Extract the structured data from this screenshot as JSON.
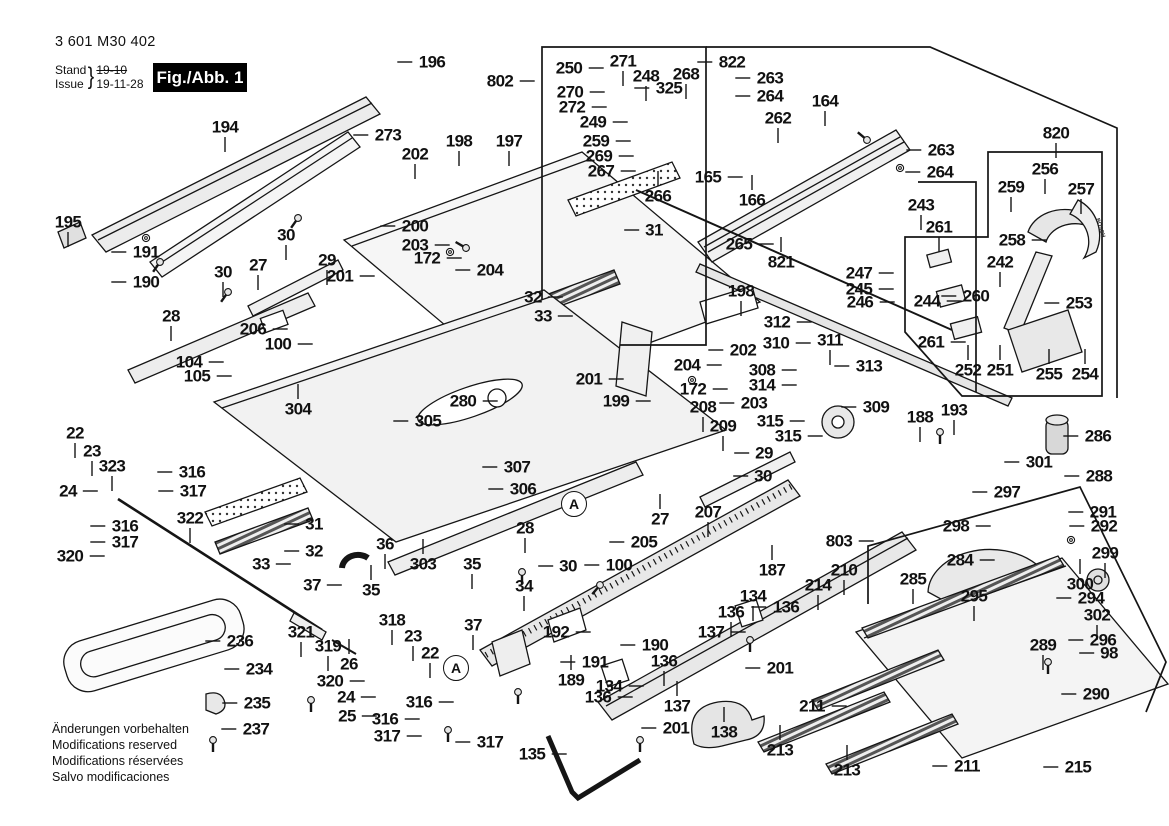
{
  "doc": {
    "part_number": "3 601 M30 402",
    "stand_label": "Stand",
    "issue_label": "Issue",
    "brace": "}",
    "date_struck": "19-10",
    "date": "19-11-28",
    "figure_badge": "Fig./Abb. 1",
    "footer_lines": [
      "Änderungen vorbehalten",
      "Modifications reserved",
      "Modifications réservées",
      "Salvo modificaciones"
    ]
  },
  "colors": {
    "ink": "#151515",
    "badge_bg": "#000000",
    "badge_fg": "#ffffff",
    "fill_light": "#f4f4f4",
    "fill_mid": "#e8e8e8",
    "fill_dark": "#d2d2d2"
  },
  "drawing_texts": [
    {
      "t": "BOSCH",
      "x": 1100,
      "y": 228,
      "rot": 72
    }
  ],
  "detail_circles": [
    {
      "t": "A",
      "x": 574,
      "y": 504
    },
    {
      "t": "A",
      "x": 456,
      "y": 668
    }
  ],
  "callouts": [
    {
      "t": "194",
      "x": 225,
      "y": 127,
      "d": "d"
    },
    {
      "t": "196",
      "x": 432,
      "y": 62,
      "d": "l"
    },
    {
      "t": "273",
      "x": 388,
      "y": 135,
      "d": "l"
    },
    {
      "t": "195",
      "x": 68,
      "y": 222,
      "d": "d"
    },
    {
      "t": "191",
      "x": 146,
      "y": 252,
      "d": "l"
    },
    {
      "t": "190",
      "x": 146,
      "y": 282,
      "d": "l"
    },
    {
      "t": "202",
      "x": 415,
      "y": 154,
      "d": "d"
    },
    {
      "t": "198",
      "x": 459,
      "y": 141,
      "d": "d"
    },
    {
      "t": "197",
      "x": 509,
      "y": 141,
      "d": "d"
    },
    {
      "t": "200",
      "x": 415,
      "y": 226,
      "d": "l"
    },
    {
      "t": "203",
      "x": 415,
      "y": 245,
      "d": "r"
    },
    {
      "t": "172",
      "x": 427,
      "y": 258,
      "d": "r"
    },
    {
      "t": "204",
      "x": 490,
      "y": 270,
      "d": "l"
    },
    {
      "t": "30",
      "x": 286,
      "y": 235,
      "d": "d"
    },
    {
      "t": "29",
      "x": 327,
      "y": 260,
      "d": "d"
    },
    {
      "t": "27",
      "x": 258,
      "y": 265,
      "d": "d"
    },
    {
      "t": "30",
      "x": 223,
      "y": 272,
      "d": "d"
    },
    {
      "t": "28",
      "x": 171,
      "y": 316,
      "d": "d"
    },
    {
      "t": "206",
      "x": 253,
      "y": 329,
      "d": "r"
    },
    {
      "t": "100",
      "x": 278,
      "y": 344,
      "d": "r"
    },
    {
      "t": "104",
      "x": 189,
      "y": 362,
      "d": "r"
    },
    {
      "t": "105",
      "x": 197,
      "y": 376,
      "d": "r"
    },
    {
      "t": "304",
      "x": 298,
      "y": 409,
      "d": "u"
    },
    {
      "t": "201",
      "x": 340,
      "y": 276,
      "d": "r"
    },
    {
      "t": "280",
      "x": 463,
      "y": 401,
      "d": "r"
    },
    {
      "t": "305",
      "x": 428,
      "y": 421,
      "d": "l"
    },
    {
      "t": "307",
      "x": 517,
      "y": 467,
      "d": "l"
    },
    {
      "t": "306",
      "x": 523,
      "y": 489,
      "d": "l"
    },
    {
      "t": "303",
      "x": 423,
      "y": 564,
      "d": "u"
    },
    {
      "t": "36",
      "x": 385,
      "y": 544,
      "d": "d"
    },
    {
      "t": "35",
      "x": 371,
      "y": 590,
      "d": "u"
    },
    {
      "t": "37",
      "x": 312,
      "y": 585,
      "d": "r"
    },
    {
      "t": "31",
      "x": 314,
      "y": 524,
      "d": "l"
    },
    {
      "t": "32",
      "x": 314,
      "y": 551,
      "d": "l"
    },
    {
      "t": "33",
      "x": 261,
      "y": 564,
      "d": "r"
    },
    {
      "t": "322",
      "x": 190,
      "y": 518,
      "d": "d"
    },
    {
      "t": "22",
      "x": 75,
      "y": 433,
      "d": "d"
    },
    {
      "t": "23",
      "x": 92,
      "y": 451,
      "d": "d"
    },
    {
      "t": "323",
      "x": 112,
      "y": 466,
      "d": "d"
    },
    {
      "t": "316",
      "x": 192,
      "y": 472,
      "d": "l"
    },
    {
      "t": "317",
      "x": 193,
      "y": 491,
      "d": "l"
    },
    {
      "t": "24",
      "x": 68,
      "y": 491,
      "d": "r"
    },
    {
      "t": "316",
      "x": 125,
      "y": 526,
      "d": "l"
    },
    {
      "t": "317",
      "x": 125,
      "y": 542,
      "d": "l"
    },
    {
      "t": "320",
      "x": 70,
      "y": 556,
      "d": "r"
    },
    {
      "t": "236",
      "x": 240,
      "y": 641,
      "d": "l"
    },
    {
      "t": "234",
      "x": 259,
      "y": 669,
      "d": "l"
    },
    {
      "t": "235",
      "x": 257,
      "y": 703,
      "d": "l"
    },
    {
      "t": "237",
      "x": 256,
      "y": 729,
      "d": "l"
    },
    {
      "t": "321",
      "x": 301,
      "y": 632,
      "d": "d"
    },
    {
      "t": "319",
      "x": 328,
      "y": 646,
      "d": "d"
    },
    {
      "t": "26",
      "x": 349,
      "y": 664,
      "d": "u"
    },
    {
      "t": "318",
      "x": 392,
      "y": 620,
      "d": "d"
    },
    {
      "t": "23",
      "x": 413,
      "y": 636,
      "d": "d"
    },
    {
      "t": "22",
      "x": 430,
      "y": 653,
      "d": "d"
    },
    {
      "t": "320",
      "x": 330,
      "y": 681,
      "d": "r"
    },
    {
      "t": "24",
      "x": 346,
      "y": 697,
      "d": "r"
    },
    {
      "t": "25",
      "x": 347,
      "y": 716,
      "d": "r"
    },
    {
      "t": "316",
      "x": 419,
      "y": 702,
      "d": "r"
    },
    {
      "t": "316",
      "x": 385,
      "y": 719,
      "d": "r"
    },
    {
      "t": "317",
      "x": 387,
      "y": 736,
      "d": "r"
    },
    {
      "t": "317",
      "x": 490,
      "y": 742,
      "d": "l"
    },
    {
      "t": "135",
      "x": 532,
      "y": 754,
      "d": "r"
    },
    {
      "t": "37",
      "x": 473,
      "y": 625,
      "d": "d"
    },
    {
      "t": "34",
      "x": 524,
      "y": 586,
      "d": "d"
    },
    {
      "t": "35",
      "x": 472,
      "y": 564,
      "d": "d"
    },
    {
      "t": "28",
      "x": 525,
      "y": 528,
      "d": "d"
    },
    {
      "t": "30",
      "x": 568,
      "y": 566,
      "d": "l"
    },
    {
      "t": "100",
      "x": 619,
      "y": 565,
      "d": "l"
    },
    {
      "t": "205",
      "x": 644,
      "y": 542,
      "d": "l"
    },
    {
      "t": "27",
      "x": 660,
      "y": 519,
      "d": "u"
    },
    {
      "t": "207",
      "x": 708,
      "y": 512,
      "d": "d"
    },
    {
      "t": "187",
      "x": 772,
      "y": 570,
      "d": "u"
    },
    {
      "t": "192",
      "x": 556,
      "y": 632,
      "d": "r"
    },
    {
      "t": "190",
      "x": 655,
      "y": 645,
      "d": "l"
    },
    {
      "t": "191",
      "x": 595,
      "y": 662,
      "d": "l"
    },
    {
      "t": "189",
      "x": 571,
      "y": 680,
      "d": "u"
    },
    {
      "t": "134",
      "x": 609,
      "y": 686,
      "d": "r"
    },
    {
      "t": "136",
      "x": 598,
      "y": 697,
      "d": "r"
    },
    {
      "t": "136",
      "x": 664,
      "y": 661,
      "d": "d"
    },
    {
      "t": "137",
      "x": 677,
      "y": 706,
      "d": "u"
    },
    {
      "t": "201",
      "x": 676,
      "y": 728,
      "d": "l"
    },
    {
      "t": "138",
      "x": 724,
      "y": 732,
      "d": "u"
    },
    {
      "t": "134",
      "x": 753,
      "y": 596,
      "d": "d"
    },
    {
      "t": "136",
      "x": 731,
      "y": 612,
      "d": "d"
    },
    {
      "t": "136",
      "x": 786,
      "y": 607,
      "d": "l"
    },
    {
      "t": "137",
      "x": 711,
      "y": 632,
      "d": "r"
    },
    {
      "t": "201",
      "x": 780,
      "y": 668,
      "d": "l"
    },
    {
      "t": "211",
      "x": 812,
      "y": 706,
      "d": "r"
    },
    {
      "t": "213",
      "x": 780,
      "y": 750,
      "d": "u"
    },
    {
      "t": "213",
      "x": 847,
      "y": 770,
      "d": "u"
    },
    {
      "t": "211",
      "x": 967,
      "y": 766,
      "d": "l"
    },
    {
      "t": "215",
      "x": 1078,
      "y": 767,
      "d": "l"
    },
    {
      "t": "214",
      "x": 818,
      "y": 585,
      "d": "d"
    },
    {
      "t": "210",
      "x": 844,
      "y": 570,
      "d": "d"
    },
    {
      "t": "803",
      "x": 839,
      "y": 541,
      "d": "r"
    },
    {
      "t": "285",
      "x": 913,
      "y": 579,
      "d": "d"
    },
    {
      "t": "295",
      "x": 974,
      "y": 596,
      "d": "d"
    },
    {
      "t": "284",
      "x": 960,
      "y": 560,
      "d": "r"
    },
    {
      "t": "294",
      "x": 1091,
      "y": 598,
      "d": "l"
    },
    {
      "t": "300",
      "x": 1080,
      "y": 584,
      "d": "u"
    },
    {
      "t": "299",
      "x": 1105,
      "y": 553,
      "d": "d"
    },
    {
      "t": "302",
      "x": 1097,
      "y": 615,
      "d": "d"
    },
    {
      "t": "296",
      "x": 1103,
      "y": 640,
      "d": "l"
    },
    {
      "t": "289",
      "x": 1043,
      "y": 645,
      "d": "d"
    },
    {
      "t": "98",
      "x": 1109,
      "y": 653,
      "d": "l"
    },
    {
      "t": "290",
      "x": 1096,
      "y": 694,
      "d": "l"
    },
    {
      "t": "291",
      "x": 1103,
      "y": 512,
      "d": "l"
    },
    {
      "t": "292",
      "x": 1104,
      "y": 526,
      "d": "l"
    },
    {
      "t": "298",
      "x": 956,
      "y": 526,
      "d": "r"
    },
    {
      "t": "297",
      "x": 1007,
      "y": 492,
      "d": "l"
    },
    {
      "t": "288",
      "x": 1099,
      "y": 476,
      "d": "l"
    },
    {
      "t": "286",
      "x": 1098,
      "y": 436,
      "d": "l"
    },
    {
      "t": "301",
      "x": 1039,
      "y": 462,
      "d": "l"
    },
    {
      "t": "188",
      "x": 920,
      "y": 417,
      "d": "d"
    },
    {
      "t": "193",
      "x": 954,
      "y": 410,
      "d": "d"
    },
    {
      "t": "309",
      "x": 876,
      "y": 407,
      "d": "l"
    },
    {
      "t": "315",
      "x": 770,
      "y": 421,
      "d": "r"
    },
    {
      "t": "315",
      "x": 788,
      "y": 436,
      "d": "r"
    },
    {
      "t": "314",
      "x": 762,
      "y": 385,
      "d": "r"
    },
    {
      "t": "308",
      "x": 762,
      "y": 370,
      "d": "r"
    },
    {
      "t": "313",
      "x": 869,
      "y": 366,
      "d": "l"
    },
    {
      "t": "311",
      "x": 830,
      "y": 340,
      "d": "d"
    },
    {
      "t": "310",
      "x": 776,
      "y": 343,
      "d": "r"
    },
    {
      "t": "312",
      "x": 777,
      "y": 322,
      "d": "r"
    },
    {
      "t": "199",
      "x": 616,
      "y": 401,
      "d": "r"
    },
    {
      "t": "201",
      "x": 589,
      "y": 379,
      "d": "r"
    },
    {
      "t": "208",
      "x": 703,
      "y": 407,
      "d": "d"
    },
    {
      "t": "209",
      "x": 723,
      "y": 426,
      "d": "d"
    },
    {
      "t": "203",
      "x": 754,
      "y": 403,
      "d": "l"
    },
    {
      "t": "172",
      "x": 693,
      "y": 389,
      "d": "r"
    },
    {
      "t": "204",
      "x": 687,
      "y": 365,
      "d": "r"
    },
    {
      "t": "202",
      "x": 743,
      "y": 350,
      "d": "l"
    },
    {
      "t": "198",
      "x": 741,
      "y": 291,
      "d": "d"
    },
    {
      "t": "29",
      "x": 764,
      "y": 453,
      "d": "l"
    },
    {
      "t": "30",
      "x": 763,
      "y": 476,
      "d": "l"
    },
    {
      "t": "265",
      "x": 739,
      "y": 244,
      "d": "r"
    },
    {
      "t": "821",
      "x": 781,
      "y": 262,
      "d": "u"
    },
    {
      "t": "247",
      "x": 859,
      "y": 273,
      "d": "r"
    },
    {
      "t": "245",
      "x": 859,
      "y": 289,
      "d": "r"
    },
    {
      "t": "246",
      "x": 860,
      "y": 302,
      "d": "r"
    },
    {
      "t": "243",
      "x": 921,
      "y": 205,
      "d": "d"
    },
    {
      "t": "261",
      "x": 939,
      "y": 227,
      "d": "d"
    },
    {
      "t": "244",
      "x": 927,
      "y": 301,
      "d": "r"
    },
    {
      "t": "261",
      "x": 931,
      "y": 342,
      "d": "r"
    },
    {
      "t": "260",
      "x": 976,
      "y": 296,
      "d": "l"
    },
    {
      "t": "242",
      "x": 1000,
      "y": 262,
      "d": "d"
    },
    {
      "t": "252",
      "x": 968,
      "y": 370,
      "d": "u"
    },
    {
      "t": "251",
      "x": 1000,
      "y": 370,
      "d": "u"
    },
    {
      "t": "255",
      "x": 1049,
      "y": 374,
      "d": "u"
    },
    {
      "t": "254",
      "x": 1085,
      "y": 374,
      "d": "u"
    },
    {
      "t": "253",
      "x": 1079,
      "y": 303,
      "d": "l"
    },
    {
      "t": "258",
      "x": 1012,
      "y": 240,
      "d": "r"
    },
    {
      "t": "259",
      "x": 1011,
      "y": 187,
      "d": "d"
    },
    {
      "t": "256",
      "x": 1045,
      "y": 169,
      "d": "d"
    },
    {
      "t": "257",
      "x": 1081,
      "y": 189,
      "d": "d"
    },
    {
      "t": "820",
      "x": 1056,
      "y": 133,
      "d": "d"
    },
    {
      "t": "822",
      "x": 732,
      "y": 62,
      "d": "l"
    },
    {
      "t": "263",
      "x": 770,
      "y": 78,
      "d": "l"
    },
    {
      "t": "264",
      "x": 770,
      "y": 96,
      "d": "l"
    },
    {
      "t": "262",
      "x": 778,
      "y": 118,
      "d": "d"
    },
    {
      "t": "164",
      "x": 825,
      "y": 101,
      "d": "d"
    },
    {
      "t": "263",
      "x": 941,
      "y": 150,
      "d": "l"
    },
    {
      "t": "264",
      "x": 940,
      "y": 172,
      "d": "l"
    },
    {
      "t": "165",
      "x": 708,
      "y": 177,
      "d": "r"
    },
    {
      "t": "166",
      "x": 752,
      "y": 200,
      "d": "u"
    },
    {
      "t": "266",
      "x": 658,
      "y": 196,
      "d": "u"
    },
    {
      "t": "267",
      "x": 601,
      "y": 171,
      "d": "r"
    },
    {
      "t": "269",
      "x": 599,
      "y": 156,
      "d": "r"
    },
    {
      "t": "259",
      "x": 596,
      "y": 141,
      "d": "r"
    },
    {
      "t": "249",
      "x": 593,
      "y": 122,
      "d": "r"
    },
    {
      "t": "272",
      "x": 572,
      "y": 107,
      "d": "r"
    },
    {
      "t": "270",
      "x": 570,
      "y": 92,
      "d": "r"
    },
    {
      "t": "250",
      "x": 569,
      "y": 68,
      "d": "r"
    },
    {
      "t": "271",
      "x": 623,
      "y": 61,
      "d": "d"
    },
    {
      "t": "248",
      "x": 646,
      "y": 76,
      "d": "d"
    },
    {
      "t": "268",
      "x": 686,
      "y": 74,
      "d": "d"
    },
    {
      "t": "325",
      "x": 669,
      "y": 88,
      "d": "l"
    },
    {
      "t": "802",
      "x": 500,
      "y": 81,
      "d": "r"
    },
    {
      "t": "31",
      "x": 654,
      "y": 230,
      "d": "l"
    },
    {
      "t": "32",
      "x": 533,
      "y": 297,
      "d": "r"
    },
    {
      "t": "33",
      "x": 543,
      "y": 316,
      "d": "r"
    }
  ]
}
